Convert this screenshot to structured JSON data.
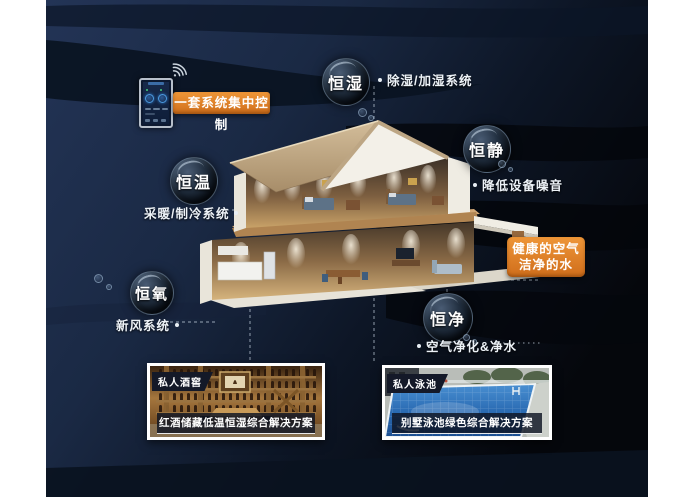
{
  "colors": {
    "accent_orange": "#df8128",
    "background_navy": "#1d2c4a",
    "background_dark": "#070b12",
    "roof_tan": "#c2ab89",
    "wall_white": "#f1eee6",
    "bubble_dark": "#0d1520"
  },
  "central_control": {
    "label": "一套系统集中控制"
  },
  "bubbles": [
    {
      "label": "恒湿",
      "desc": "除湿/加湿系统"
    },
    {
      "label": "恒静",
      "desc": "降低设备噪音"
    },
    {
      "label": "恒温",
      "desc": "采暖/制冷系统"
    },
    {
      "label": "恒氧",
      "desc": "新风系统"
    },
    {
      "label": "恒净",
      "desc": "空气净化&净水"
    }
  ],
  "highlight_box": {
    "line1": "健康的空气",
    "line2": "洁净的水"
  },
  "photo_cards": [
    {
      "badge": "私人酒窖",
      "caption": "红酒储藏低温恒湿综合解决方案"
    },
    {
      "badge": "私人泳池",
      "caption": "别墅泳池绿色综合解决方案"
    }
  ]
}
